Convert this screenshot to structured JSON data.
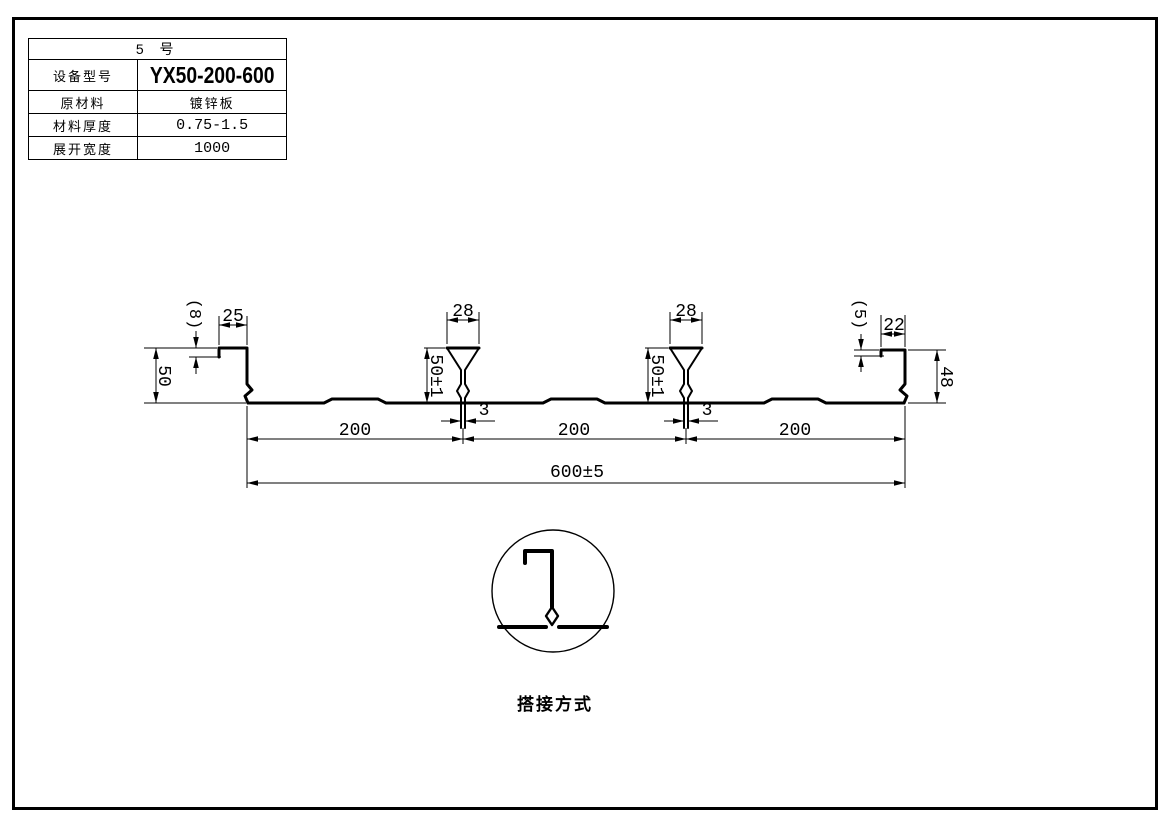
{
  "spec_table": {
    "title": "5 号",
    "rows": [
      {
        "label": "设备型号",
        "value": "YX50-200-600"
      },
      {
        "label": "原材料",
        "value": "镀锌板"
      },
      {
        "label": "材料厚度",
        "value": "0.75-1.5"
      },
      {
        "label": "展开宽度",
        "value": "1000"
      }
    ]
  },
  "profile_drawing": {
    "dimensions": {
      "left_lip": "(8)",
      "left_top_flange": "25",
      "left_height": "50",
      "rib1_width": "28",
      "rib1_height": "50±1",
      "seam1_width": "3",
      "rib2_width": "28",
      "rib2_height": "50±1",
      "seam2_width": "3",
      "right_lip": "(5)",
      "right_top_flange": "22",
      "right_height": "48",
      "pitch1": "200",
      "pitch2": "200",
      "pitch3": "200",
      "overall_width": "600±5"
    }
  },
  "lap_detail": {
    "caption": "搭接方式"
  },
  "colors": {
    "line": "#000000",
    "background": "#ffffff"
  }
}
